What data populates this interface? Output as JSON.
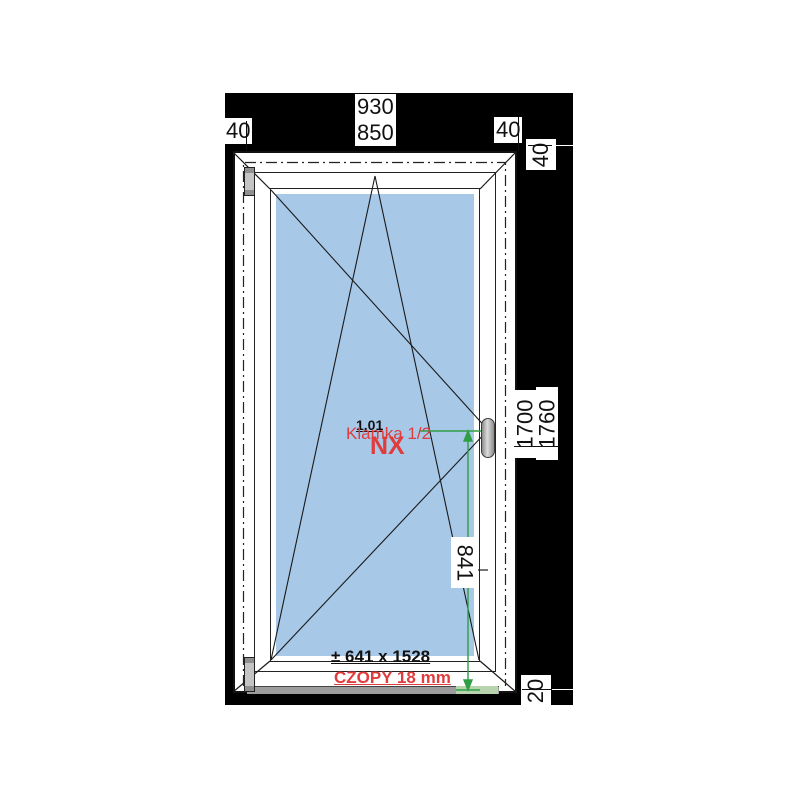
{
  "dims": {
    "width_total": "930",
    "width_inner": "850",
    "offset_left": "40",
    "offset_right": "40",
    "offset_top": "40",
    "height_inner": "1700",
    "height_total": "1760",
    "handle_height": "841",
    "offset_bottom": "20"
  },
  "annotations": {
    "position_number": "1.01",
    "handle_note": "Klamka 1/2",
    "system_code": "NX",
    "glass_dimensions": "± 641 x 1528",
    "tenons_note": "CZOPY 18 mm"
  },
  "colors": {
    "background": "#000000",
    "glass": "#a8c8e8",
    "annotation_red": "#e03c3c",
    "dimension_green": "#2f9e44"
  }
}
